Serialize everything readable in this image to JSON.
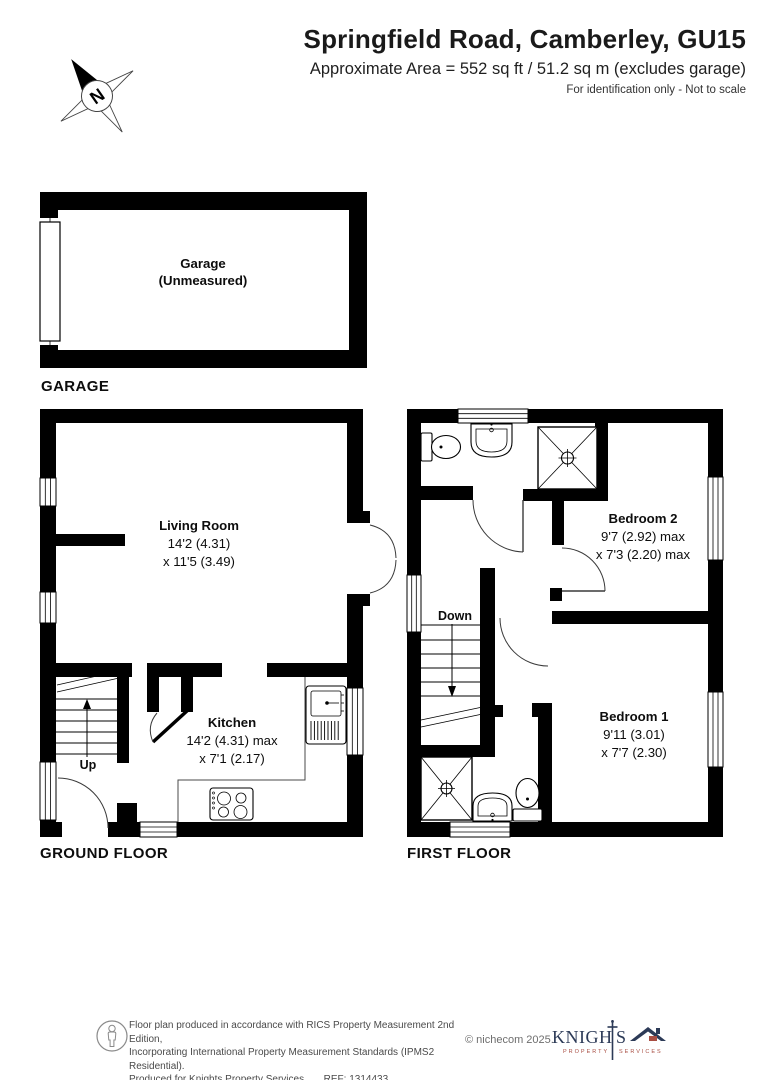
{
  "header": {
    "title": "Springfield Road, Camberley, GU15",
    "subtitle": "Approximate Area = 552 sq ft / 51.2 sq m (excludes garage)",
    "note": "For identification only - Not to scale"
  },
  "compass": {
    "label": "N"
  },
  "plans": {
    "garage": {
      "caption": "GARAGE",
      "room": {
        "name": "Garage",
        "note": "(Unmeasured)"
      }
    },
    "ground": {
      "caption": "GROUND FLOOR",
      "living_room": {
        "name": "Living Room",
        "dim1": "14'2 (4.31)",
        "dim2": "x 11'5 (3.49)"
      },
      "kitchen": {
        "name": "Kitchen",
        "dim1": "14'2 (4.31) max",
        "dim2": "x 7'1 (2.17)"
      },
      "stairs_label": "Up"
    },
    "first": {
      "caption": "FIRST FLOOR",
      "bedroom2": {
        "name": "Bedroom 2",
        "dim1": "9'7 (2.92) max",
        "dim2": "x 7'3 (2.20) max"
      },
      "bedroom1": {
        "name": "Bedroom 1",
        "dim1": "9'11 (3.01)",
        "dim2": "x 7'7 (2.30)"
      },
      "stairs_label": "Down"
    }
  },
  "footer": {
    "disclaimer_line1": "Floor plan produced in accordance with RICS Property Measurement 2nd Edition,",
    "disclaimer_line2": "Incorporating International Property Measurement Standards (IPMS2 Residential).",
    "disclaimer_line3": "Produced for Knights Property Services.",
    "ref": "REF: 1314433",
    "copyright": "© nichecom 2025.",
    "logo": {
      "name_part1": "KNIGH",
      "name_part2": "S",
      "sub_left": "PROPERTY",
      "sub_right": "SERVICES"
    }
  },
  "colors": {
    "wall": "#000000",
    "logo_navy": "#2c3a57",
    "logo_red": "#a94e43",
    "footer_text": "#4a4a4a"
  }
}
